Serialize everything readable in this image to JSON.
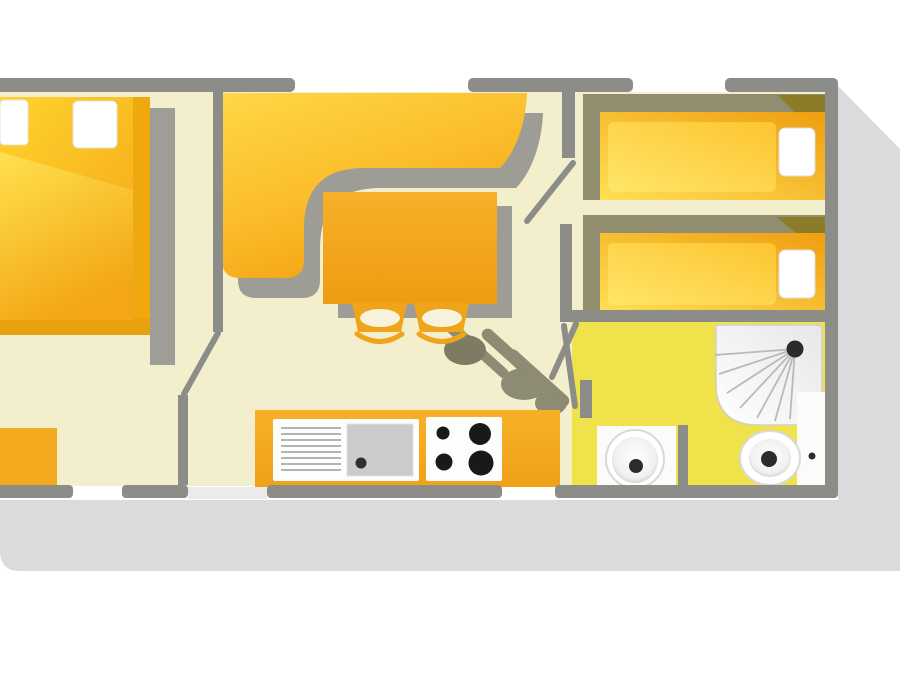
{
  "title": "mobile-home-floor-plan",
  "colors": {
    "background": "#ffffff",
    "outer_drop_shadow": "#dbdbde",
    "wall": "#8c8c88",
    "floor": "#f3efcd",
    "bathroom_floor": "#efe24b",
    "furniture_orange_light": "#ffd94a",
    "furniture_orange_deep": "#f2a013",
    "kitchen_counter": "#f3a81d",
    "room_shadow_olive": "#908e6f",
    "furniture_shadow_gray": "#9e9e96",
    "bed_fold_dark": "#8c7c2a",
    "fixture_white": "#fbfbf9",
    "fixture_detail_dark": "#2b2b2b",
    "sink_gray": "#cbcbca"
  },
  "rooms": [
    {
      "id": "master-bedroom",
      "label": "Master bedroom with double bed and wardrobe"
    },
    {
      "id": "living-dining",
      "label": "Living and dining area with corner sofa, table and two chairs"
    },
    {
      "id": "kitchen",
      "label": "Kitchen with sink unit and four-burner hob"
    },
    {
      "id": "twin-bedroom",
      "label": "Second bedroom with two single beds"
    },
    {
      "id": "bathroom",
      "label": "Bathroom with shower, washbasin and toilet"
    }
  ],
  "furniture": {
    "double_bed": "double-bed",
    "double_bed_pillows": "two-pillows",
    "wardrobe": "wardrobe-cabinet",
    "corner_sofa": "l-shaped-corner-sofa",
    "dining_table": "dining-table",
    "chairs": "two-dining-chairs",
    "single_bed_top": "single-bed-upper",
    "single_bed_bottom": "single-bed-lower",
    "kitchen_sink": "sink-with-drainboard",
    "hob": "four-burner-hob",
    "shower": "corner-shower",
    "washbasin": "round-washbasin",
    "toilet": "toilet"
  }
}
